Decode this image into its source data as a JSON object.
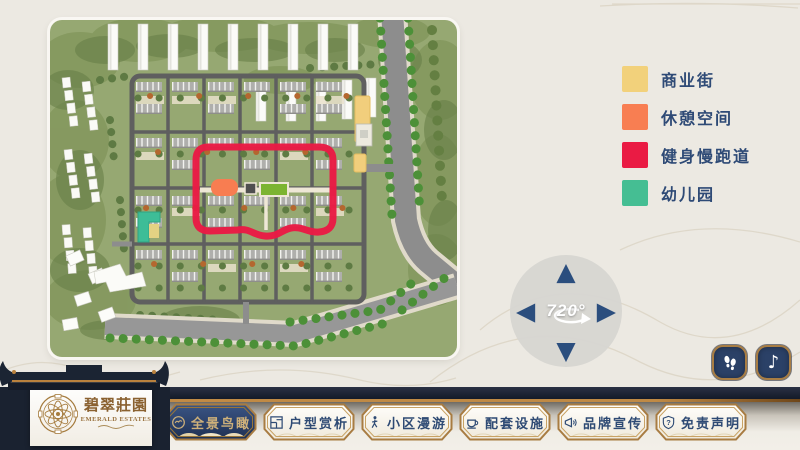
{
  "legend": {
    "items": [
      {
        "name": "commercial-street",
        "label": "商业街",
        "color": "#F2D17B"
      },
      {
        "name": "rest-space",
        "label": "休憩空间",
        "color": "#F87E52"
      },
      {
        "name": "fitness-jogging-track",
        "label": "健身慢跑道",
        "color": "#EA1B44"
      },
      {
        "name": "kindergarten",
        "label": "幼儿园",
        "color": "#45BE93"
      }
    ]
  },
  "rotate_control": {
    "label": "720°",
    "icons": [
      "arrow-up-icon",
      "arrow-left-icon",
      "arrow-right-icon",
      "arrow-down-icon",
      "rotate-swoosh-icon"
    ]
  },
  "nav": {
    "items": [
      {
        "label": "全景鸟瞰",
        "icon": "panorama-icon",
        "active": true
      },
      {
        "label": "户型赏析",
        "icon": "floorplan-icon",
        "active": false
      },
      {
        "label": "小区漫游",
        "icon": "roam-icon",
        "active": false
      },
      {
        "label": "配套设施",
        "icon": "facilities-icon",
        "active": false
      },
      {
        "label": "品牌宣传",
        "icon": "brand-promo-icon",
        "active": false
      },
      {
        "label": "免责声明",
        "icon": "disclaimer-icon",
        "active": false
      }
    ]
  },
  "brand": {
    "title_cn": "碧翠莊園",
    "title_en": "EMERALD ESTATES"
  },
  "corner_buttons": [
    {
      "icon": "footprints-icon"
    },
    {
      "icon": "music-note-icon"
    }
  ],
  "colors": {
    "background": "#ECE9E2",
    "bar_navy": "#161D2B",
    "gold": "#A87C42",
    "button_navy": "#2B4166",
    "legend_text": "#2E4A76",
    "track_red": "#EA1B44"
  }
}
